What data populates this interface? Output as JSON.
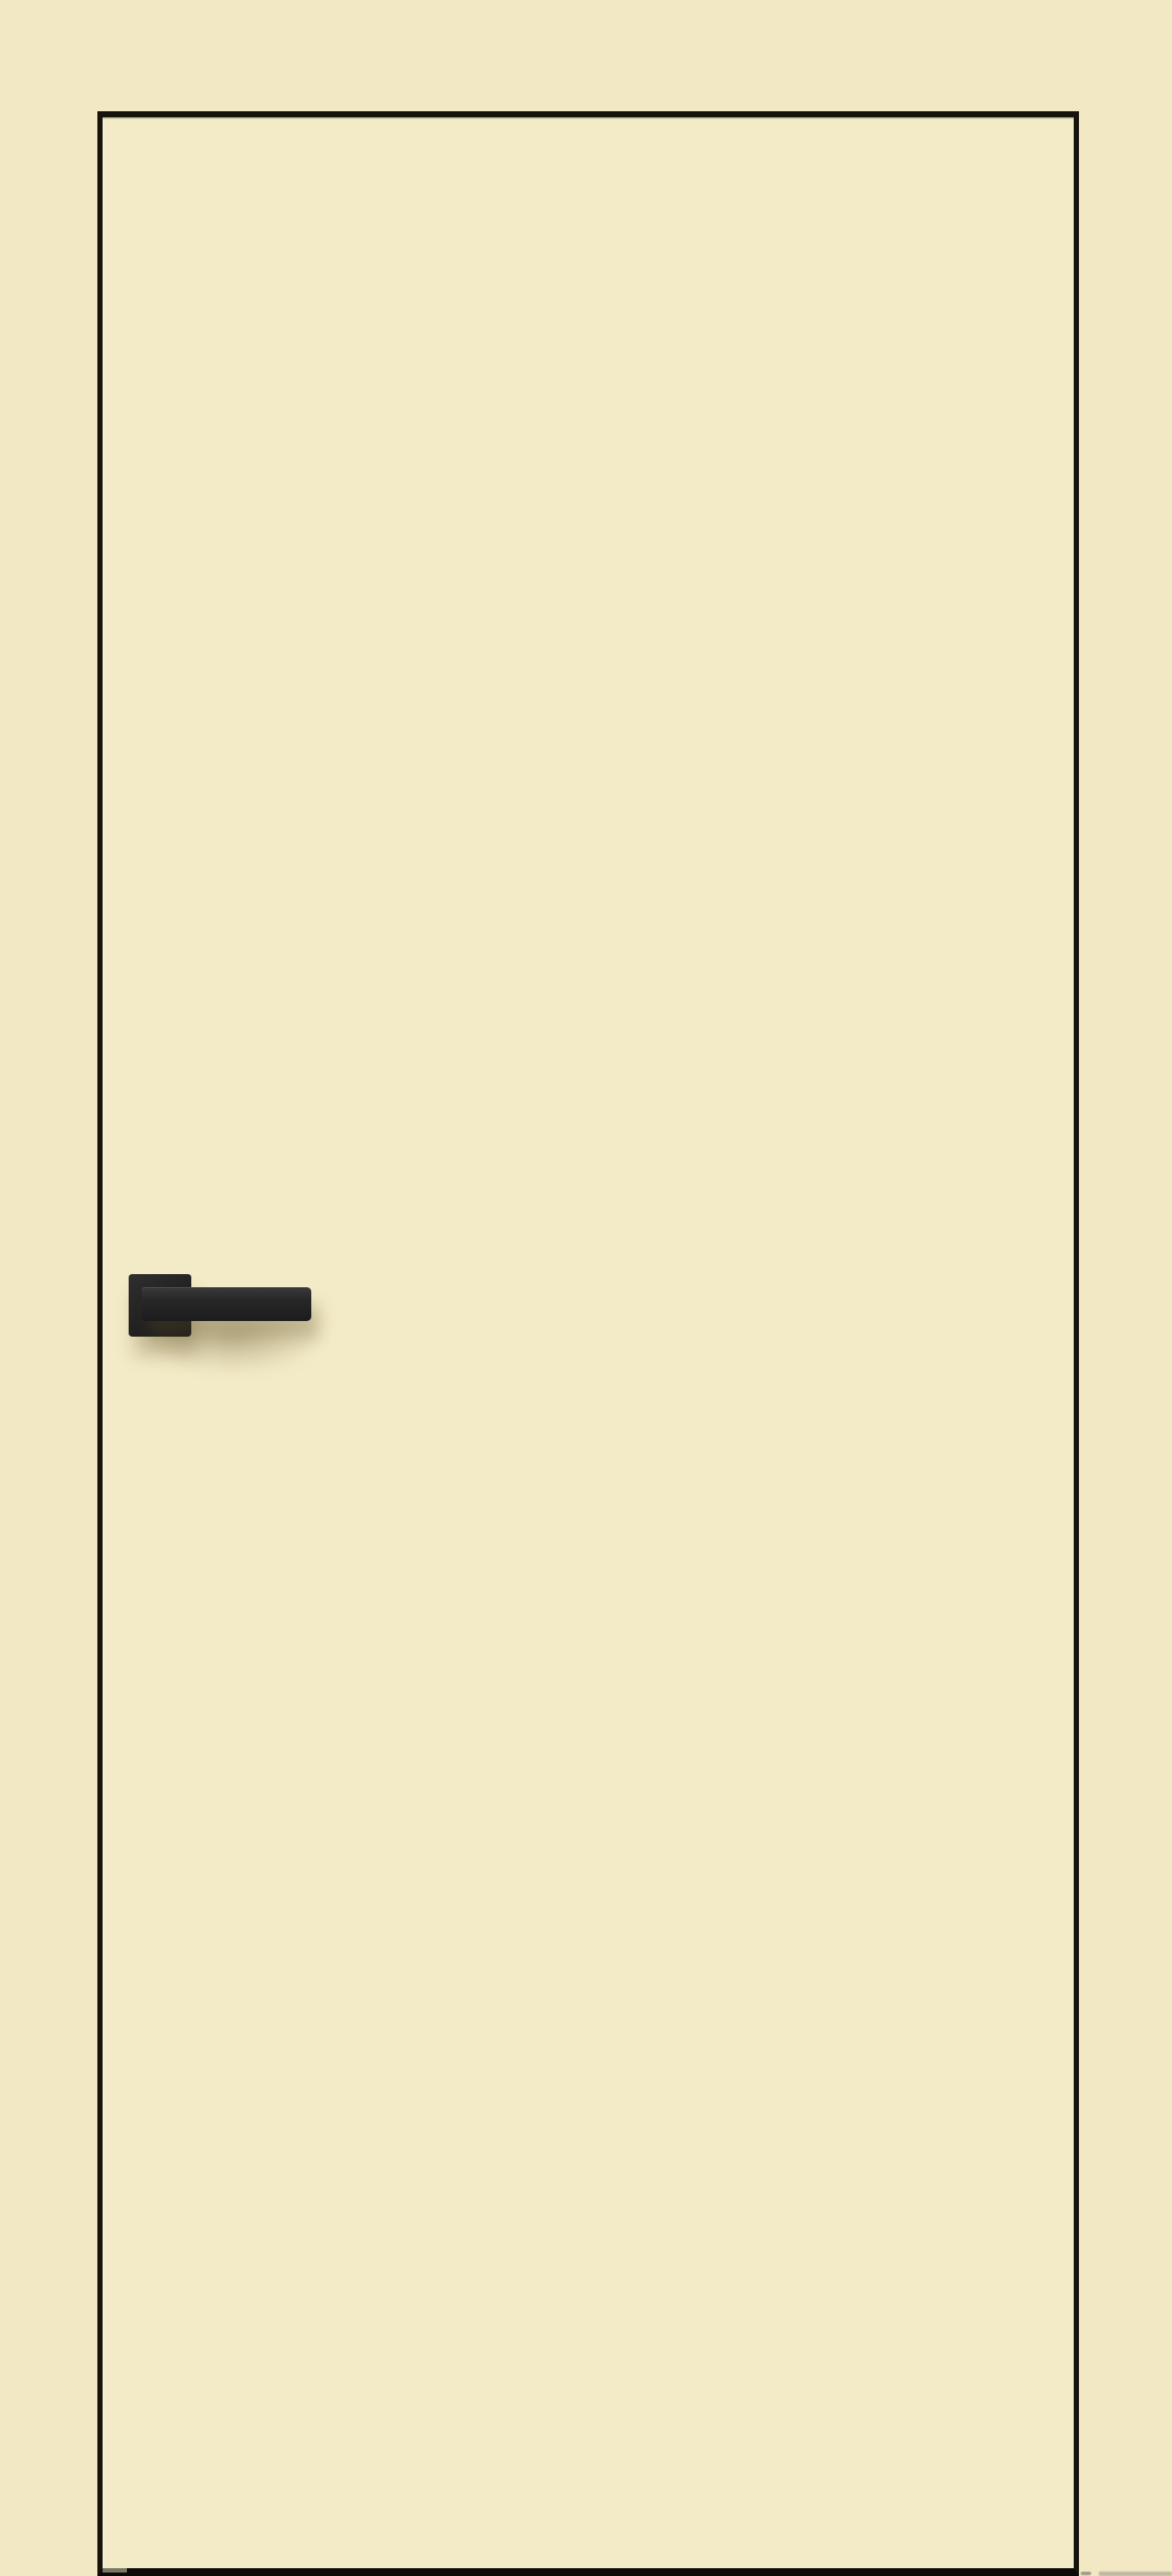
{
  "scene": {
    "subject": "Cream interior door leaf with dark edge trim and matte-black lever handle on a square rosette"
  },
  "colors": {
    "background": "#f2e9c4",
    "door_face": "#f3ebc7",
    "door_edge": "#17130d",
    "door_bottom_edge": "#0b0a08",
    "handle": "#242424",
    "handle_highlight": "#3b3b3b",
    "handle_shadow": "rgba(99,82,40,0.35)",
    "floor_smudge": "#b2ab94"
  }
}
